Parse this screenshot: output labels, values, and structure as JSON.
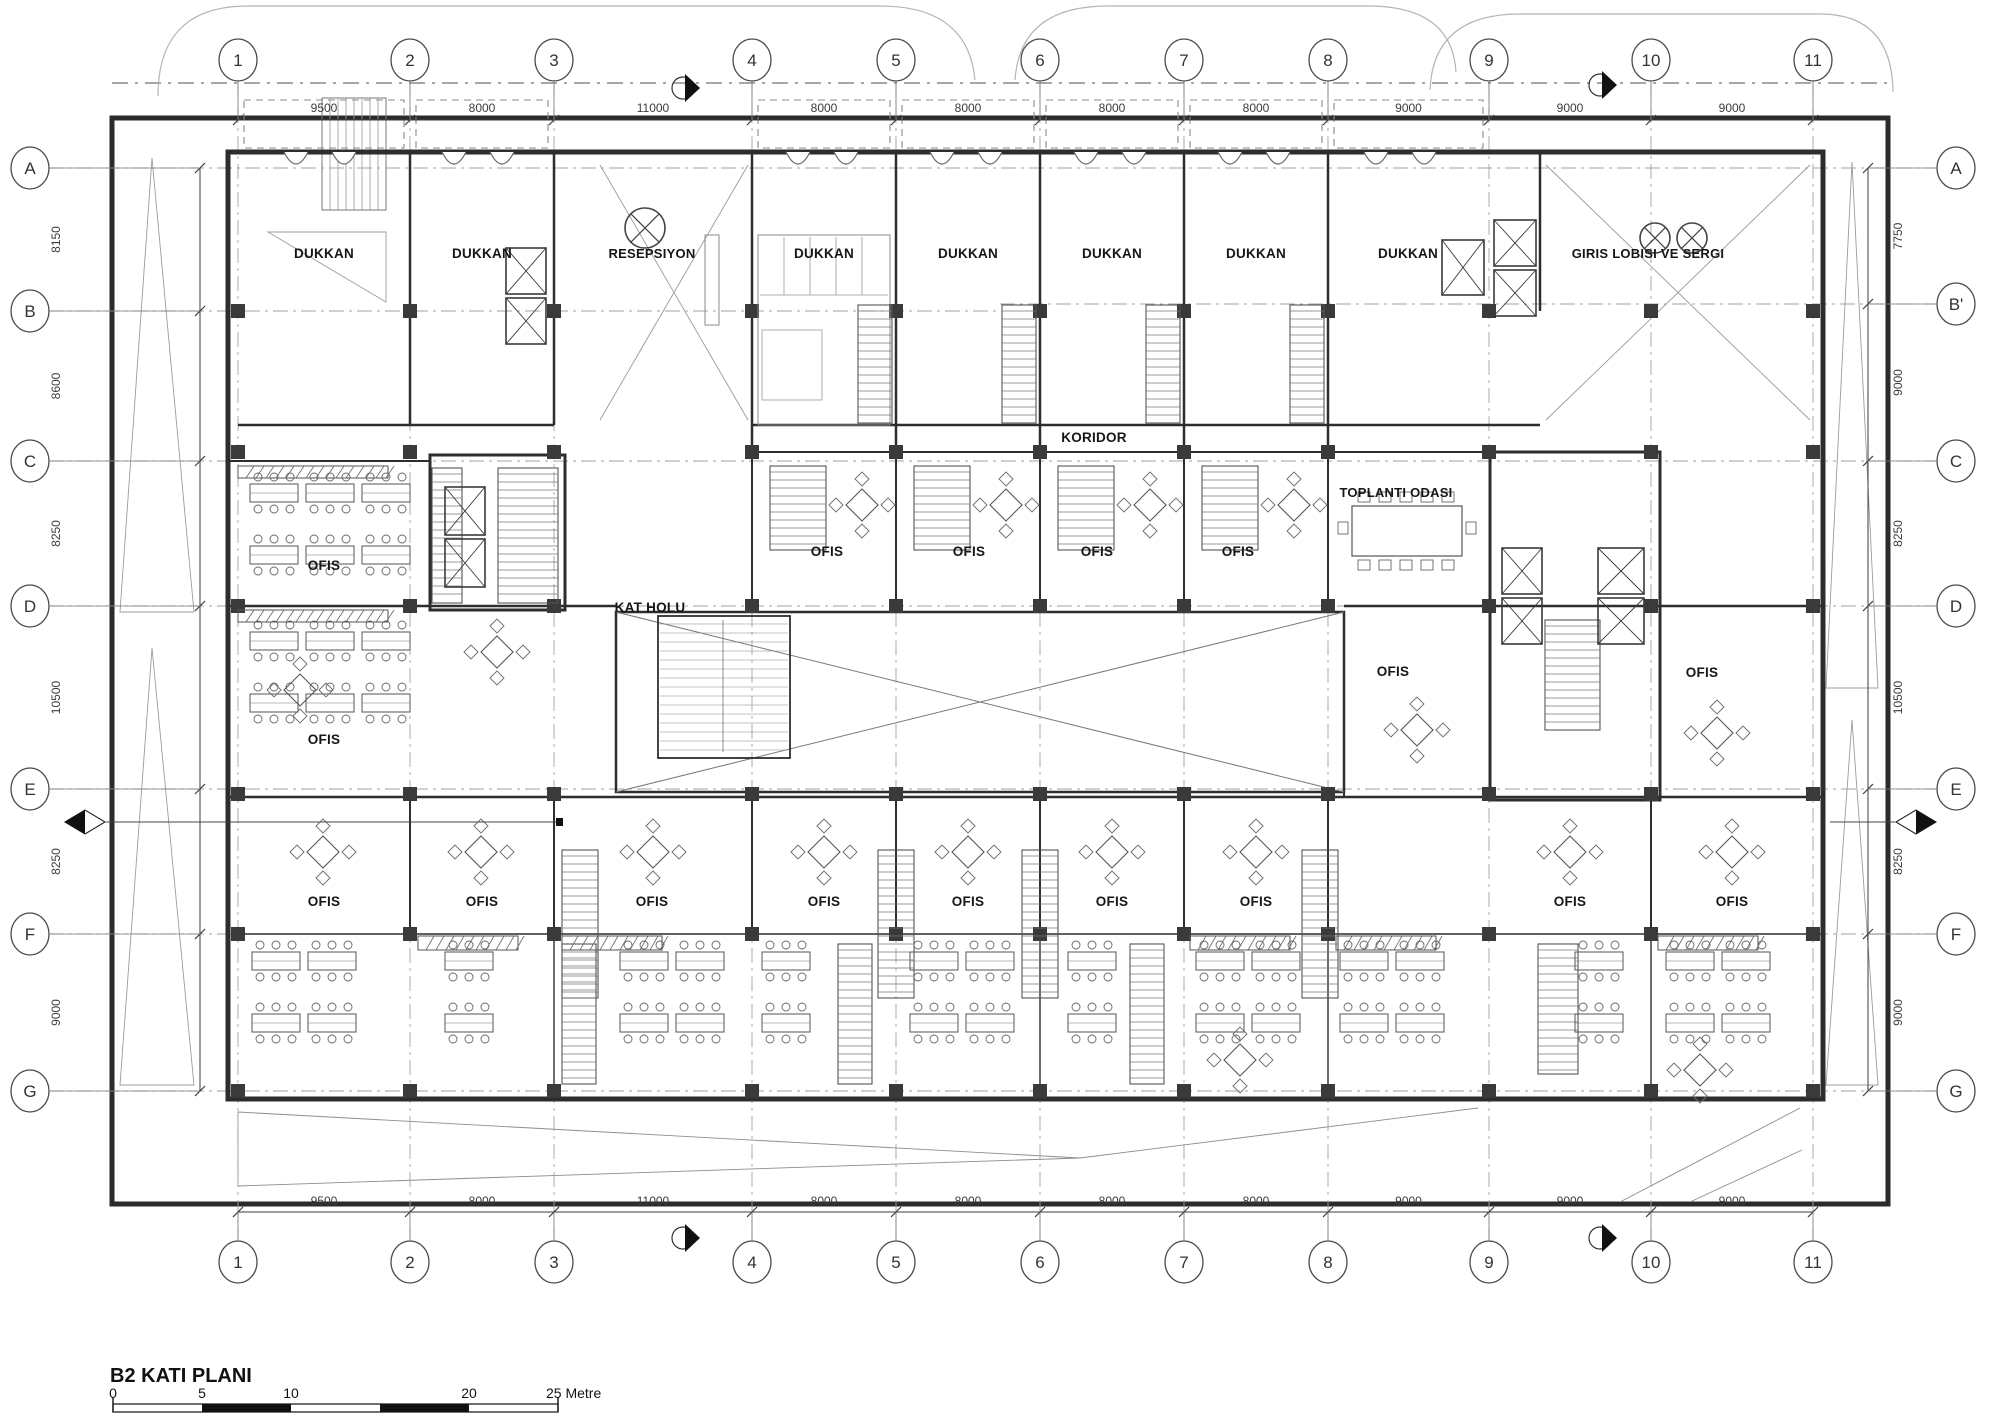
{
  "sheet": {
    "title": "B2 KATI PLANI",
    "scale_bar": {
      "unit": "Metre",
      "ticks": [
        "0",
        "5",
        "10",
        "20",
        "25"
      ]
    }
  },
  "colors": {
    "wall": "#2d2d2d",
    "medium": "#555555",
    "light": "#8f8f8f",
    "grid": "#a3a3a3",
    "dim": "#3c3c3c",
    "label": "#161616",
    "paper": "#ffffff"
  },
  "grid": {
    "columns": [
      {
        "label": "1",
        "x": 238
      },
      {
        "label": "2",
        "x": 410
      },
      {
        "label": "3",
        "x": 554
      },
      {
        "label": "4",
        "x": 752
      },
      {
        "label": "5",
        "x": 896
      },
      {
        "label": "6",
        "x": 1040
      },
      {
        "label": "7",
        "x": 1184
      },
      {
        "label": "8",
        "x": 1328
      },
      {
        "label": "9",
        "x": 1489
      },
      {
        "label": "10",
        "x": 1651
      },
      {
        "label": "11",
        "x": 1813
      }
    ],
    "rows_left": [
      {
        "label": "A",
        "y": 168
      },
      {
        "label": "B",
        "y": 311
      },
      {
        "label": "C",
        "y": 461
      },
      {
        "label": "D",
        "y": 606
      },
      {
        "label": "E",
        "y": 789
      },
      {
        "label": "F",
        "y": 934
      },
      {
        "label": "G",
        "y": 1091
      }
    ],
    "rows_right": [
      {
        "label": "A",
        "y": 168
      },
      {
        "label": "B'",
        "y": 304
      },
      {
        "label": "C",
        "y": 461
      },
      {
        "label": "D",
        "y": 606
      },
      {
        "label": "E",
        "y": 789
      },
      {
        "label": "F",
        "y": 934
      },
      {
        "label": "G",
        "y": 1091
      }
    ],
    "dims_top": [
      "9500",
      "8000",
      "11000",
      "8000",
      "8000",
      "8000",
      "8000",
      "9000",
      "9000",
      "9000"
    ],
    "dims_bottom": [
      "9500",
      "8000",
      "11000",
      "8000",
      "8000",
      "8000",
      "8000",
      "9000",
      "9000",
      "9000"
    ],
    "dims_left": [
      "8150",
      "8600",
      "8250",
      "10500",
      "8250",
      "9000"
    ],
    "dims_right": [
      "7750",
      "9000",
      "8250",
      "10500",
      "8250",
      "9000"
    ]
  },
  "rooms": [
    {
      "label": "DUKKAN",
      "x": 324,
      "y": 258
    },
    {
      "label": "DUKKAN",
      "x": 482,
      "y": 258
    },
    {
      "label": "RESEPSIYON",
      "x": 652,
      "y": 258
    },
    {
      "label": "DUKKAN",
      "x": 824,
      "y": 258
    },
    {
      "label": "DUKKAN",
      "x": 968,
      "y": 258
    },
    {
      "label": "DUKKAN",
      "x": 1112,
      "y": 258
    },
    {
      "label": "DUKKAN",
      "x": 1256,
      "y": 258
    },
    {
      "label": "DUKKAN",
      "x": 1408,
      "y": 258
    },
    {
      "label": "GIRIS LOBISI VE SERGI",
      "x": 1648,
      "y": 258
    },
    {
      "label": "KORIDOR",
      "x": 1094,
      "y": 442
    },
    {
      "label": "KAT HOLU",
      "x": 650,
      "y": 612
    },
    {
      "label": "OFIS",
      "x": 324,
      "y": 570
    },
    {
      "label": "OFIS",
      "x": 827,
      "y": 556
    },
    {
      "label": "OFIS",
      "x": 969,
      "y": 556
    },
    {
      "label": "OFIS",
      "x": 1097,
      "y": 556
    },
    {
      "label": "OFIS",
      "x": 1238,
      "y": 556
    },
    {
      "label": "TOPLANTI ODASI",
      "x": 1396,
      "y": 497
    },
    {
      "label": "OFIS",
      "x": 324,
      "y": 744
    },
    {
      "label": "OFIS",
      "x": 1393,
      "y": 676
    },
    {
      "label": "OFIS",
      "x": 1702,
      "y": 677
    },
    {
      "label": "OFIS",
      "x": 324,
      "y": 906
    },
    {
      "label": "OFIS",
      "x": 482,
      "y": 906
    },
    {
      "label": "OFIS",
      "x": 652,
      "y": 906
    },
    {
      "label": "OFIS",
      "x": 824,
      "y": 906
    },
    {
      "label": "OFIS",
      "x": 968,
      "y": 906
    },
    {
      "label": "OFIS",
      "x": 1112,
      "y": 906
    },
    {
      "label": "OFIS",
      "x": 1256,
      "y": 906
    },
    {
      "label": "OFIS",
      "x": 1570,
      "y": 906
    },
    {
      "label": "OFIS",
      "x": 1732,
      "y": 906
    }
  ]
}
